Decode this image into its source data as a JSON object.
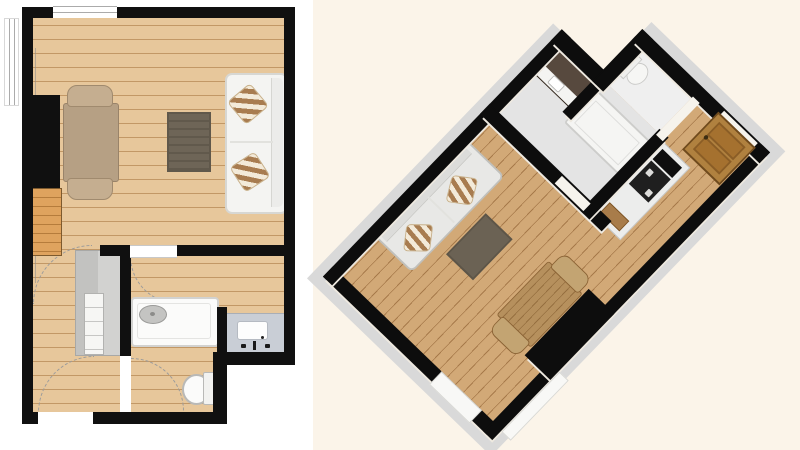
{
  "scene": {
    "type": "floor-plan-viewer",
    "left_view": "2D top-down apartment floor plan",
    "right_view": "3D bird's-eye apartment floor plan rotated about 45 degrees",
    "visible_text": "none"
  },
  "palette": {
    "page_background": "#ffffff",
    "right_pane_background": "#fbf4e9",
    "wall_black": "#101010",
    "wood_floor_2d": "#e7c79b",
    "wood_floor_3d": "#d2a977",
    "tile_floor_3d": "#e4e4e4",
    "outer_slab_gray": "#d9d9d9",
    "floor_edge_green": "#96c272",
    "rug_dark": "#6e6557",
    "sofa_white": "#f4f4f2",
    "cushion_stripe_brown": "#a87c50",
    "cushion_stripe_cream": "#f3ead9",
    "table_wood": "#b6a084",
    "kitchen_gray": "#c2c2c0",
    "vanity_gray_blue": "#c9ced6",
    "vanity_dark_3d": "#57493e",
    "entrance_door_wood": "#b0813f",
    "fixture_white": "#fbfbfa",
    "door_swing_dash": "#9b9b9b"
  },
  "plan_2d": {
    "rooms": [
      {
        "name": "living-room",
        "floor": "wood",
        "openings": [
          "window-top-wall",
          "window-left-wall"
        ]
      },
      {
        "name": "hallway",
        "floor": "wood",
        "openings": [
          "entrance-door-bottom-wall"
        ]
      },
      {
        "name": "bathroom",
        "floor": "wood",
        "openings": [
          "door-to-living-room"
        ]
      },
      {
        "name": "wc",
        "floor": "wood",
        "openings": [
          "door-to-hallway"
        ]
      }
    ],
    "furniture": [
      {
        "name": "dining-table",
        "room": "living-room"
      },
      {
        "name": "chair",
        "room": "living-room",
        "count": 2
      },
      {
        "name": "rug",
        "room": "living-room"
      },
      {
        "name": "sofa",
        "room": "living-room",
        "cushions": 2,
        "cushion_pattern": "diagonal-stripes"
      },
      {
        "name": "wood-cabinet",
        "room": "living-room"
      },
      {
        "name": "kitchen-unit",
        "room": "hallway"
      },
      {
        "name": "bathtub",
        "room": "bathroom"
      },
      {
        "name": "sink-vanity",
        "room": "bathroom"
      },
      {
        "name": "toilet",
        "room": "wc"
      }
    ],
    "annotations": [
      "door-swing-arcs-dashed"
    ]
  },
  "plan_3d": {
    "rotation_deg": 224,
    "floors": {
      "living_hall": "wood-with-green-edging",
      "bathroom_wc": "light-gray"
    },
    "furniture": [
      {
        "name": "sofa",
        "cushions": 2
      },
      {
        "name": "rug"
      },
      {
        "name": "dining-table"
      },
      {
        "name": "chair",
        "count": 2
      },
      {
        "name": "kitchen-counter",
        "details": [
          "cooktop",
          "oven",
          "wood-crate"
        ]
      },
      {
        "name": "sink-vanity",
        "style": "dark-cabinet-white-top"
      },
      {
        "name": "bathtub"
      },
      {
        "name": "toilet"
      },
      {
        "name": "entrance-door",
        "style": "standing-wood-panel-door"
      }
    ]
  }
}
